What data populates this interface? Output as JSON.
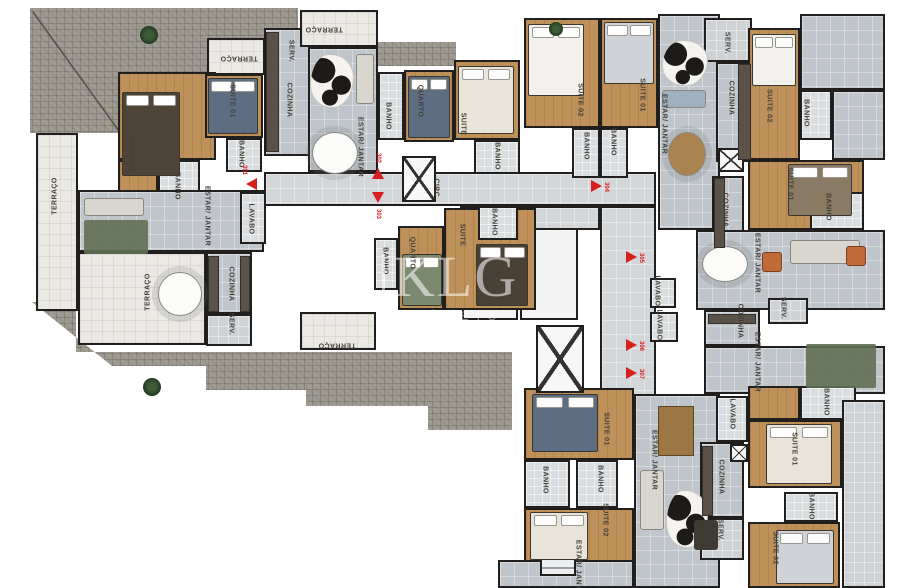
{
  "watermark": {
    "brand": "KLG",
    "subtitle": "IMÓVEIS"
  },
  "palette": {
    "accent_red": "#d61f1f",
    "wall": "#201f1d",
    "wood_floor": "#bd9159",
    "living_floor": "#bfc5ca",
    "terrace_floor": "#ebe9e4",
    "masonry_grey": "#99948c",
    "label_text": "#45413a",
    "watermark_white": "rgba(255,255,255,0.55)"
  },
  "labels": [
    {
      "t": "TERRAÇO",
      "x": 55,
      "y": 196,
      "r": -90
    },
    {
      "t": "SUITE 02",
      "x": 131,
      "y": 155,
      "r": 90
    },
    {
      "t": "BANHO",
      "x": 177,
      "y": 186,
      "r": 90
    },
    {
      "t": "SUITE 01",
      "x": 232,
      "y": 101,
      "r": 90
    },
    {
      "t": "BANHO",
      "x": 241,
      "y": 154,
      "r": 90
    },
    {
      "t": "COZINHA",
      "x": 289,
      "y": 100,
      "r": 90
    },
    {
      "t": "SERV.",
      "x": 291,
      "y": 51,
      "r": 90
    },
    {
      "t": "TERRAÇO",
      "x": 239,
      "y": 58,
      "r": 180
    },
    {
      "t": "TERRAÇO",
      "x": 148,
      "y": 292,
      "r": -90
    },
    {
      "t": "ESTAR/ JANTAR",
      "x": 207,
      "y": 216,
      "r": 90
    },
    {
      "t": "LAVABO",
      "x": 251,
      "y": 219,
      "r": 90
    },
    {
      "t": "COZINHA",
      "x": 231,
      "y": 284,
      "r": 90
    },
    {
      "t": "SERV.",
      "x": 231,
      "y": 324,
      "r": 90
    },
    {
      "t": "TERRAÇO",
      "x": 337,
      "y": 345,
      "r": 180
    },
    {
      "t": "TERRAÇO",
      "x": 324,
      "y": 29,
      "r": 180
    },
    {
      "t": "ESTAR/ JANTAR",
      "x": 360,
      "y": 147,
      "r": 90
    },
    {
      "t": "BANHO",
      "x": 388,
      "y": 116,
      "r": 90
    },
    {
      "t": "QUARTO",
      "x": 420,
      "y": 101,
      "r": 90
    },
    {
      "t": "SUITE",
      "x": 463,
      "y": 124,
      "r": 90
    },
    {
      "t": "BANHO",
      "x": 497,
      "y": 156,
      "r": 90
    },
    {
      "t": "CIRC.",
      "x": 436,
      "y": 189,
      "r": 90
    },
    {
      "t": "BANHO",
      "x": 385,
      "y": 261,
      "r": 90
    },
    {
      "t": "QUARTO",
      "x": 412,
      "y": 253,
      "r": 90
    },
    {
      "t": "SUITE",
      "x": 462,
      "y": 235,
      "r": 90
    },
    {
      "t": "BANHO",
      "x": 494,
      "y": 222,
      "r": 90
    },
    {
      "t": "SUITE 02",
      "x": 580,
      "y": 100,
      "r": 90
    },
    {
      "t": "SUITE 01",
      "x": 642,
      "y": 95,
      "r": 90
    },
    {
      "t": "BANHO",
      "x": 586,
      "y": 146,
      "r": 90
    },
    {
      "t": "BANHO",
      "x": 613,
      "y": 142,
      "r": 90
    },
    {
      "t": "ESTAR/ JANTAR",
      "x": 664,
      "y": 124,
      "r": 90
    },
    {
      "t": "SERV.",
      "x": 727,
      "y": 43,
      "r": 90
    },
    {
      "t": "COZINHA",
      "x": 731,
      "y": 98,
      "r": 90
    },
    {
      "t": "SUITE 02",
      "x": 769,
      "y": 106,
      "r": 90
    },
    {
      "t": "BANHO",
      "x": 806,
      "y": 113,
      "r": 90
    },
    {
      "t": "SUITE 01",
      "x": 790,
      "y": 184,
      "r": 90
    },
    {
      "t": "BANHO",
      "x": 828,
      "y": 207,
      "r": 90
    },
    {
      "t": "COZINHA",
      "x": 725,
      "y": 210,
      "r": 90
    },
    {
      "t": "ESTAR/ JANTAR",
      "x": 757,
      "y": 263,
      "r": 90
    },
    {
      "t": "SERV.",
      "x": 783,
      "y": 308,
      "r": 90
    },
    {
      "t": "COZINHA",
      "x": 740,
      "y": 321,
      "r": 90
    },
    {
      "t": "ESTAR/ JANTAR",
      "x": 757,
      "y": 362,
      "r": 90
    },
    {
      "t": "LAVABO",
      "x": 657,
      "y": 291,
      "r": 90
    },
    {
      "t": "LAVABO",
      "x": 659,
      "y": 325,
      "r": 90
    },
    {
      "t": "SUITE 01",
      "x": 606,
      "y": 429,
      "r": 90
    },
    {
      "t": "BANHO",
      "x": 545,
      "y": 480,
      "r": 90
    },
    {
      "t": "BANHO",
      "x": 600,
      "y": 479,
      "r": 90
    },
    {
      "t": "SUITE 02",
      "x": 605,
      "y": 520,
      "r": 90
    },
    {
      "t": "ESTAR/ JANTAR",
      "x": 654,
      "y": 460,
      "r": 90
    },
    {
      "t": "ESTAR/ JANTAR",
      "x": 578,
      "y": 570,
      "r": 90
    },
    {
      "t": "LAVABO",
      "x": 732,
      "y": 414,
      "r": 90
    },
    {
      "t": "COZINHA",
      "x": 721,
      "y": 477,
      "r": 90
    },
    {
      "t": "SERV.",
      "x": 720,
      "y": 530,
      "r": 90
    },
    {
      "t": "SUITE 01",
      "x": 794,
      "y": 449,
      "r": 90
    },
    {
      "t": "BANHO",
      "x": 826,
      "y": 402,
      "r": 90
    },
    {
      "t": "BANHO",
      "x": 811,
      "y": 506,
      "r": 90
    },
    {
      "t": "SUITE 02",
      "x": 775,
      "y": 548,
      "r": 90
    }
  ],
  "units": [
    {
      "number": "301",
      "dir": "left",
      "arrow": {
        "x": 252,
        "y": 184
      },
      "num": {
        "x": 244,
        "y": 170
      }
    },
    {
      "number": "302",
      "dir": "up",
      "arrow": {
        "x": 378,
        "y": 174
      },
      "num": {
        "x": 378,
        "y": 158
      }
    },
    {
      "number": "303",
      "dir": "down",
      "arrow": {
        "x": 378,
        "y": 198
      },
      "num": {
        "x": 378,
        "y": 214
      }
    },
    {
      "number": "304",
      "dir": "right",
      "arrow": {
        "x": 597,
        "y": 186
      },
      "num": {
        "x": 606,
        "y": 187
      }
    },
    {
      "number": "305",
      "dir": "right",
      "arrow": {
        "x": 632,
        "y": 257
      },
      "num": {
        "x": 641,
        "y": 258
      }
    },
    {
      "number": "306",
      "dir": "right",
      "arrow": {
        "x": 632,
        "y": 345
      },
      "num": {
        "x": 641,
        "y": 346
      }
    },
    {
      "number": "307",
      "dir": "right",
      "arrow": {
        "x": 632,
        "y": 373
      },
      "num": {
        "x": 641,
        "y": 374
      }
    }
  ]
}
